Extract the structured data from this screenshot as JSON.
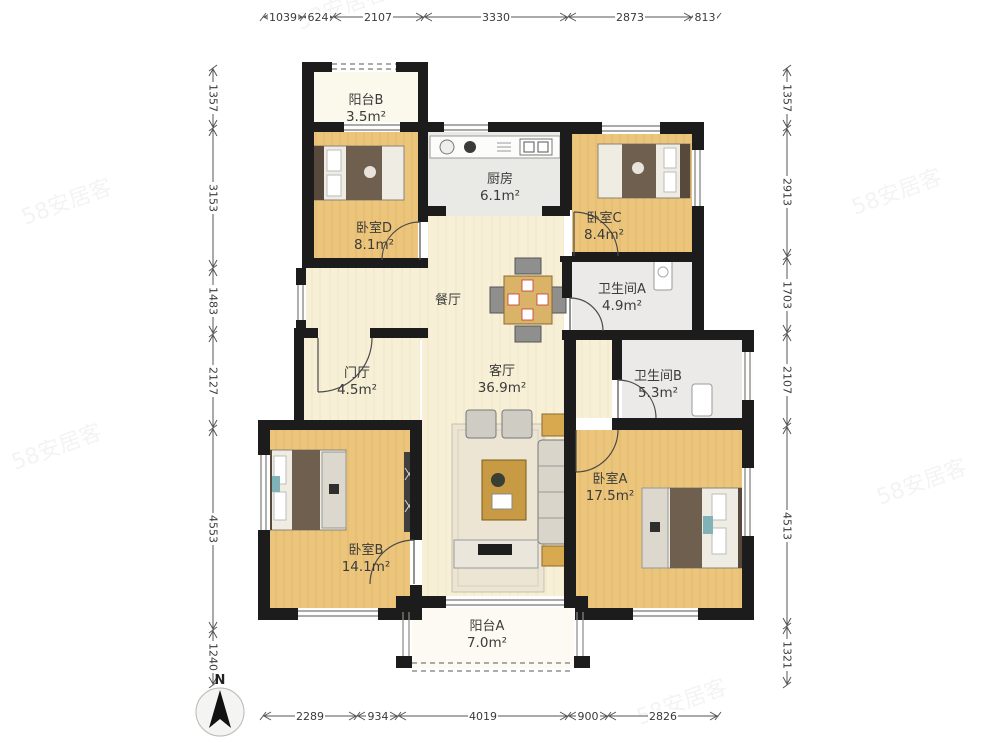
{
  "plan": {
    "compass_label": "N",
    "watermark": "58安居客",
    "rooms": [
      {
        "id": "balcony-b",
        "name": "阳台B",
        "area": "3.5m²"
      },
      {
        "id": "bedroom-d",
        "name": "卧室D",
        "area": "8.1m²"
      },
      {
        "id": "kitchen",
        "name": "厨房",
        "area": "6.1m²"
      },
      {
        "id": "bedroom-c",
        "name": "卧室C",
        "area": "8.4m²"
      },
      {
        "id": "bathroom-a",
        "name": "卫生间A",
        "area": "4.9m²"
      },
      {
        "id": "dining",
        "name": "餐厅",
        "area": ""
      },
      {
        "id": "foyer",
        "name": "门厅",
        "area": "4.5m²"
      },
      {
        "id": "living",
        "name": "客厅",
        "area": "36.9m²"
      },
      {
        "id": "bathroom-b",
        "name": "卫生间B",
        "area": "5.3m²"
      },
      {
        "id": "bedroom-a",
        "name": "卧室A",
        "area": "17.5m²"
      },
      {
        "id": "bedroom-b",
        "name": "卧室B",
        "area": "14.1m²"
      },
      {
        "id": "balcony-a",
        "name": "阳台A",
        "area": "7.0m²"
      }
    ],
    "dimensions_mm": {
      "top": [
        "1039",
        "624",
        "2107",
        "3330",
        "2873",
        "813"
      ],
      "left": [
        "1357",
        "3153",
        "1483",
        "2127",
        "4553",
        "1240"
      ],
      "right": [
        "1357",
        "2913",
        "1703",
        "2107",
        "4513",
        "1321"
      ],
      "bottom": [
        "2289",
        "934",
        "4019",
        "900",
        "2826"
      ]
    },
    "colors": {
      "wall": "#1c1c1c",
      "wood_floor": "#ecc57c",
      "cream_floor": "#f7f0d7",
      "tile_floor": "#e9e9e6",
      "balcony_floor": "#fbf8ec",
      "blanket": "#6e5f4e",
      "accent_teal": "#7fb3b8"
    }
  }
}
